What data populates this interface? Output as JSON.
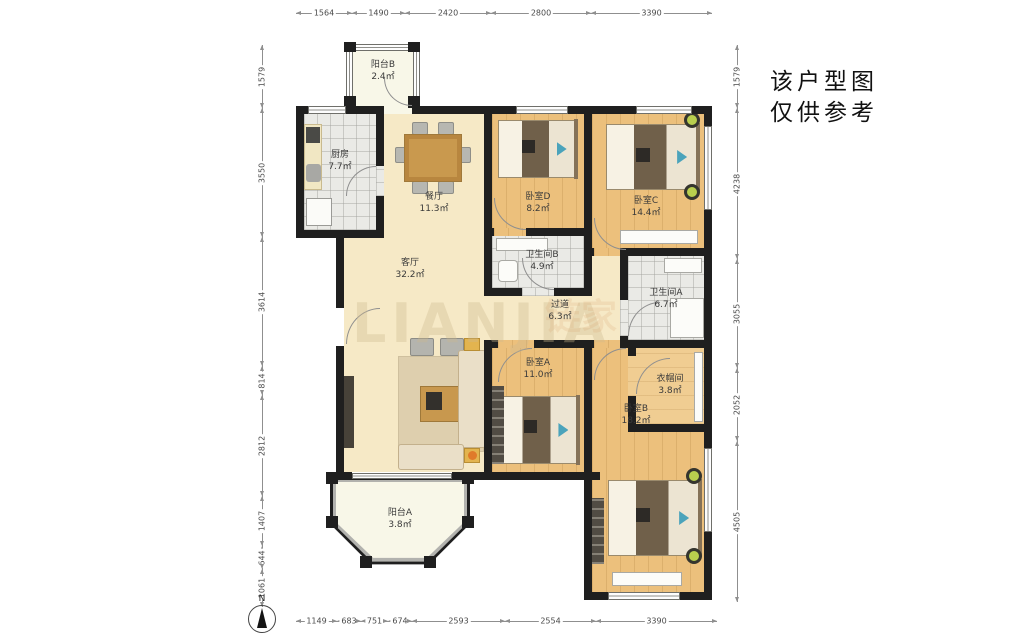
{
  "disclaimer": {
    "line1": "该户型图",
    "line2": "仅供参考"
  },
  "watermark": {
    "primary": "LIANJIA",
    "secondary": "链家"
  },
  "compass": {
    "label": "N"
  },
  "rooms": {
    "balcony_b": {
      "name": "阳台B",
      "area": "2.4㎡"
    },
    "kitchen": {
      "name": "厨房",
      "area": "7.7㎡"
    },
    "dining": {
      "name": "餐厅",
      "area": "11.3㎡"
    },
    "living": {
      "name": "客厅",
      "area": "32.2㎡"
    },
    "bedroom_d": {
      "name": "卧室D",
      "area": "8.2㎡"
    },
    "bedroom_c": {
      "name": "卧室C",
      "area": "14.4㎡"
    },
    "bath_b": {
      "name": "卫生间B",
      "area": "4.9㎡"
    },
    "bath_a": {
      "name": "卫生间A",
      "area": "6.7㎡"
    },
    "hallway": {
      "name": "过道",
      "area": "6.3㎡"
    },
    "bedroom_a": {
      "name": "卧室A",
      "area": "11.0㎡"
    },
    "bedroom_b": {
      "name": "卧室B",
      "area": "18.2㎡"
    },
    "cloakroom": {
      "name": "衣帽间",
      "area": "3.8㎡"
    },
    "balcony_a": {
      "name": "阳台A",
      "area": "3.8㎡"
    }
  },
  "dimensions": {
    "top": [
      "1564",
      "1490",
      "2420",
      "2800",
      "3390"
    ],
    "bottom": [
      "1149",
      "683",
      "751",
      "674",
      "2593",
      "2554",
      "3390"
    ],
    "left": [
      "1579",
      "3550",
      "3614",
      "814",
      "2812",
      "1407",
      "644",
      "1061"
    ],
    "right": [
      "1579",
      "4238",
      "3055",
      "2052",
      "4505"
    ]
  },
  "colors": {
    "wall": "#1f1f1f",
    "wood_floor": "#ecc07c",
    "beige_floor": "#f6e9c6",
    "tile_floor": "#eaeae6",
    "balcony_floor": "#f8f7e8",
    "accent_teal": "#4ba3bb",
    "watermark": "#cdb98e"
  }
}
